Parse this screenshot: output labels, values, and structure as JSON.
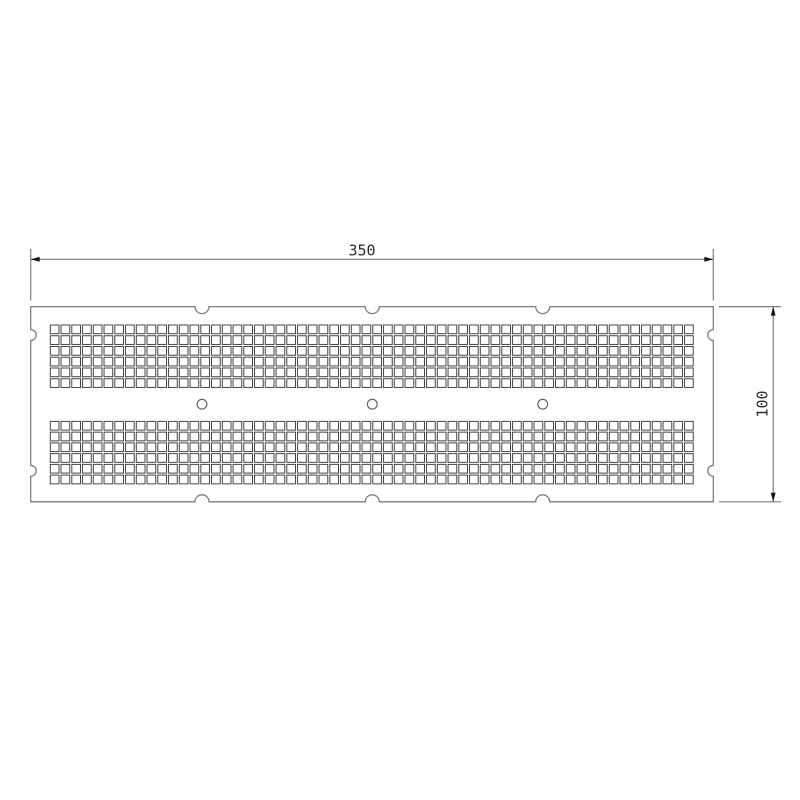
{
  "page": {
    "background": "#ffffff",
    "width": 800,
    "height": 800
  },
  "drawing": {
    "type": "technical-drawing",
    "description": "Perforated rectangular plate with two 6-row grids of square holes, three round holes on the centerline, and semicircular edge notches, dimensioned 350 wide by 100 high",
    "colors": {
      "background": "#ffffff",
      "plate_outline": "#7e7e7e",
      "square_hole": "#454545",
      "round_hole": "#5a5a5a",
      "dimension_line": "#7e7e7e",
      "arrow": "#141414",
      "text": "#2a2a2a"
    },
    "plate": {
      "x": 30.7,
      "y": 306.6,
      "width": 682.6,
      "height": 195.2,
      "top_notches_x": [
        202,
        372.3,
        542.7
      ],
      "bottom_notches_x": [
        202,
        372.3,
        542.7
      ],
      "left_notches_y": [
        335,
        470.8
      ],
      "right_notches_y": [
        335,
        470.8
      ],
      "notch_radius_top_bottom": 7,
      "notch_radius_sides": 5.5
    },
    "hole_grid": {
      "columns": 60,
      "rows_per_block": 6,
      "pitch": 10.75,
      "square_size": 8.7,
      "x_start": 50.3,
      "block_y_starts": [
        325,
        421.4
      ]
    },
    "mount_holes": {
      "cx": [
        202,
        372.3,
        542.7
      ],
      "cy": 404.2,
      "radius": 4.9
    },
    "dimensions": {
      "arrow_length": 9,
      "arrow_half_width": 2.4,
      "width": {
        "label": "350",
        "line_y": 259.3,
        "x1": 30.7,
        "x2": 713.3,
        "ext_y1": 249,
        "ext_y2": 300.5,
        "text_x": 362,
        "text_y": 250.5
      },
      "height": {
        "label": "100",
        "line_x": 773.2,
        "y1": 306.6,
        "y2": 501.8,
        "ext_x1": 719,
        "ext_x2": 781,
        "text_x": 762.5,
        "text_y": 403.5
      }
    }
  }
}
